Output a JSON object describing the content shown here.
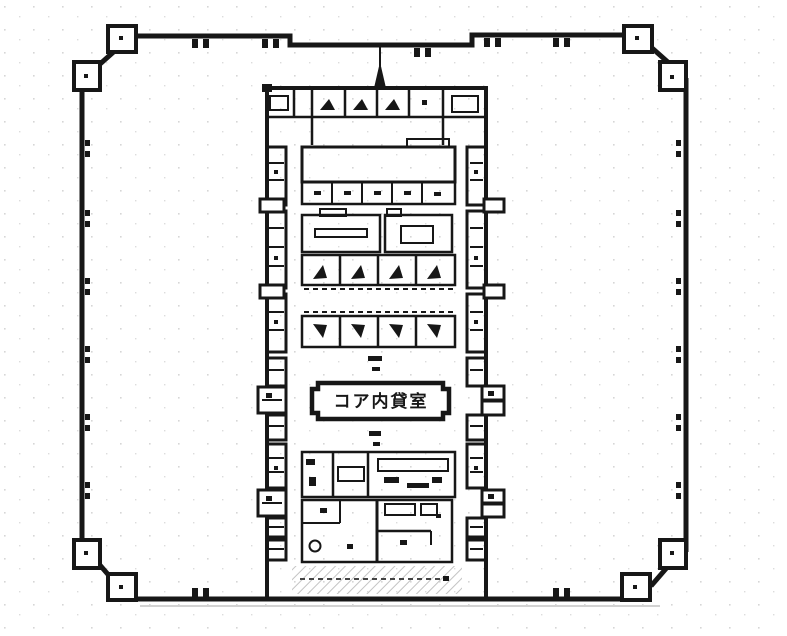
{
  "plan": {
    "core_label": "コア内貸室",
    "colors": {
      "ink": "#171717",
      "paper": "#ffffff",
      "hatch": "#c4c4c4",
      "shadow": "#d2d2d2"
    },
    "structure": {
      "elevator_banks": 2,
      "elevators_per_bank": 4
    }
  }
}
